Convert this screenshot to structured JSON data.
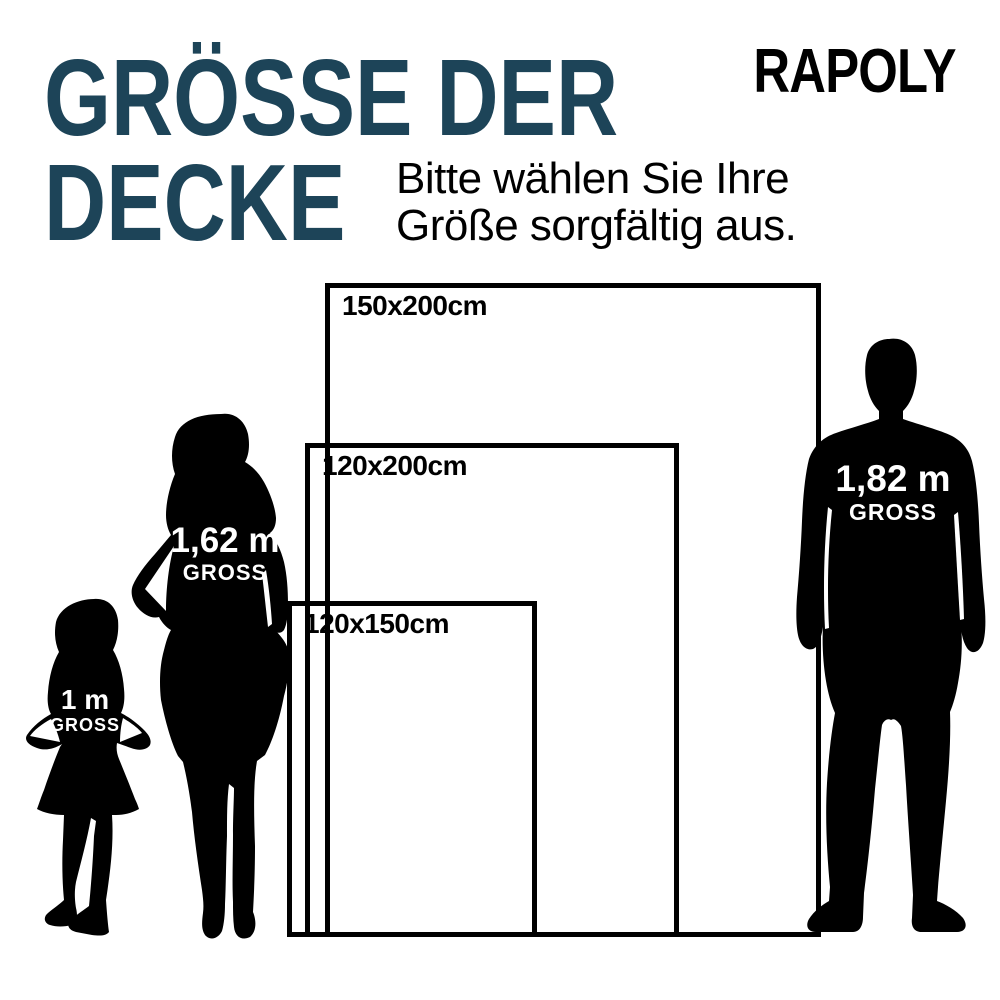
{
  "brand": "RAPOLY",
  "title": {
    "line1": "GRÖSSE DER",
    "line2": "DECKE"
  },
  "subtitle": {
    "line1": "Bitte wählen Sie Ihre",
    "line2": "Größe sorgfältig aus."
  },
  "sizes": [
    {
      "label": "150x200cm",
      "width_cm": 150,
      "height_cm": 200
    },
    {
      "label": "120x200cm",
      "width_cm": 120,
      "height_cm": 200
    },
    {
      "label": "120x150cm",
      "width_cm": 120,
      "height_cm": 150
    }
  ],
  "figures": [
    {
      "name": "girl",
      "height_label": "1 m",
      "unit_label": "GROSS",
      "height_m": 1.0
    },
    {
      "name": "woman",
      "height_label": "1,62 m",
      "unit_label": "GROSS",
      "height_m": 1.62
    },
    {
      "name": "man",
      "height_label": "1,82 m",
      "unit_label": "GROSS",
      "height_m": 1.82
    }
  ],
  "colors": {
    "title": "#1d4458",
    "text": "#000000",
    "border": "#000000",
    "silhouette": "#000000",
    "figure_label": "#ffffff",
    "background": "#ffffff"
  }
}
